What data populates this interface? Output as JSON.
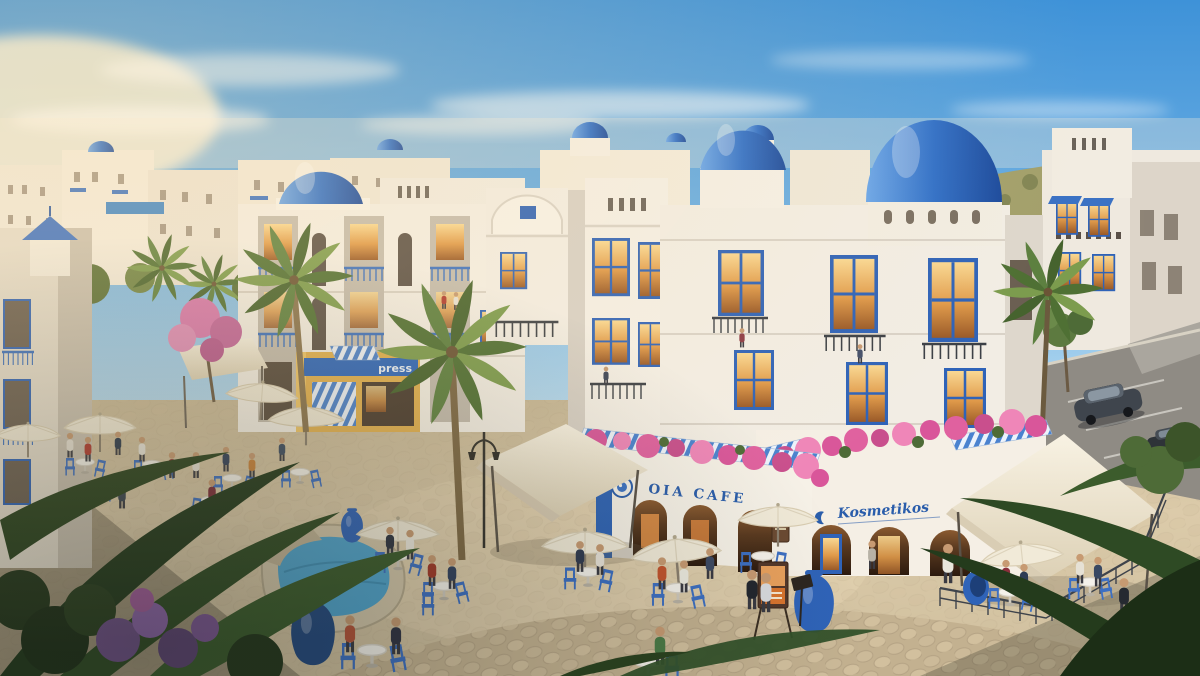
{
  "meta": {
    "type": "architectural-rendering",
    "subject": "Mediterranean seaside resort plaza with cafes and apartments",
    "style": "Greek-island white buildings with blue domes",
    "time_of_day": "golden hour"
  },
  "signs": {
    "cafe": "OIA CAFE",
    "boutique": "Kosmetikos",
    "shop_partial": "press"
  },
  "palette": {
    "sky_top": "#3e92d8",
    "sky_horizon": "#fdf0da",
    "dome_blue": "#2f6fc8",
    "accent_blue": "#2f63b8",
    "building_white": "#f3efe7",
    "building_shadow": "#d5cec4",
    "window_glow": "#e8a45f",
    "awning_cream": "#f1ead8",
    "chair_blue": "#3d6fc2",
    "shop_yellow": "#e3b150",
    "plaza_stone": "#d8c7a7",
    "foliage_green": "#5f7c3a",
    "bougainvillea_pink": "#e0619f",
    "pool_blue": "#57a7d0",
    "car_gray": "#3f454d"
  },
  "scene_objects": [
    "blue-domed apartment buildings",
    "cafe terrace with white canopies and umbrellas",
    "cosmetics boutique arcade",
    "yellow shopfront",
    "stone fountain pool with blue jars",
    "palm trees and bougainvillea",
    "parking area with two cars",
    "pedestrians and cafe guests"
  ]
}
